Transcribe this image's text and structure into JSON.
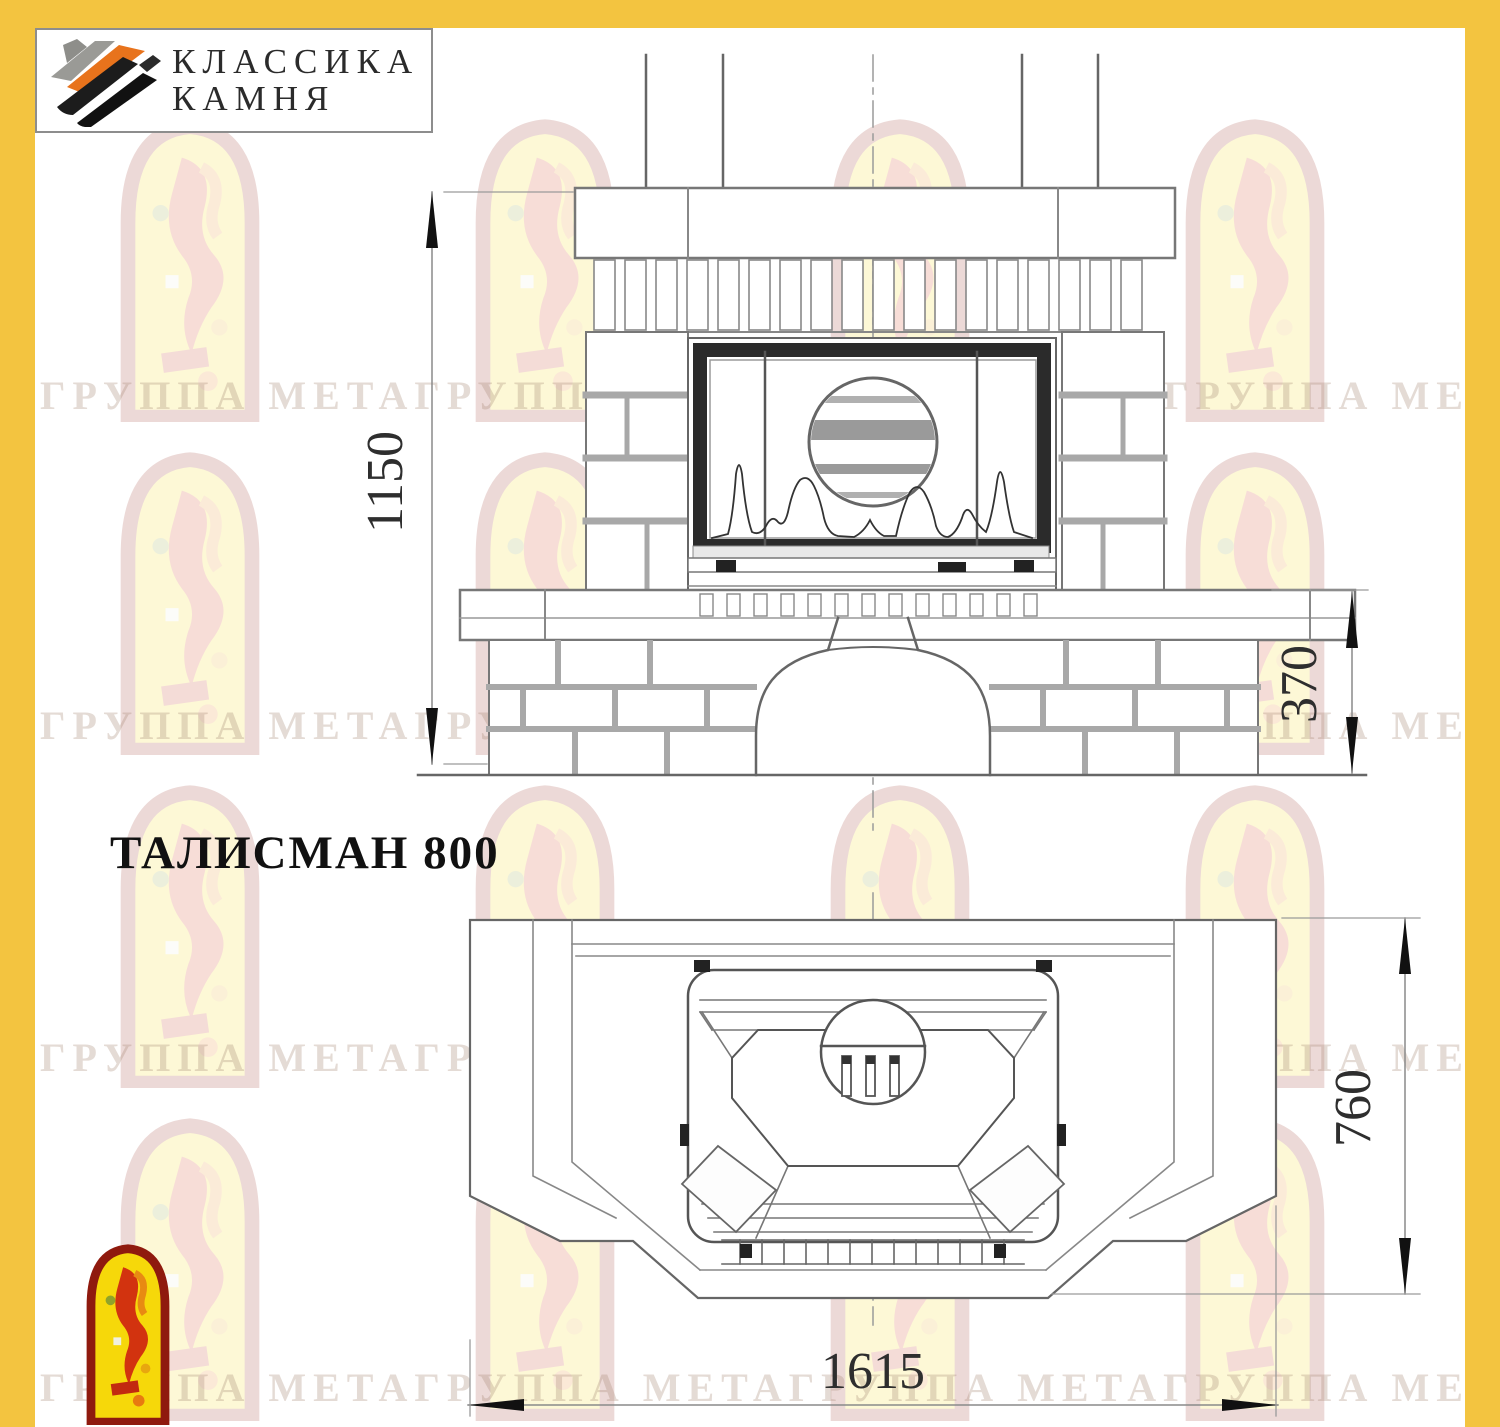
{
  "brand": {
    "name_line1": "КЛАССИКА",
    "name_line2": "КАМНЯ",
    "icon": "stone-slabs-icon"
  },
  "drawing": {
    "title": "ТАЛИСМАН 800",
    "views": {
      "front_view": "fireplace-front-elevation",
      "plan_view": "fireplace-top-plan"
    },
    "dimensions": {
      "front_total_height": "1150",
      "bench_height": "370",
      "plan_depth": "760",
      "plan_width": "1615"
    }
  },
  "watermark": {
    "row_text": "ГРУППА МЕТАГРУППА МЕТАГРУППА МЕТАГРУППА МЕТА",
    "arch_icon": "meta-arch-logo"
  },
  "colors": {
    "frame_yellow": "#F3C440",
    "logo_arch_red": "#8F1A0E",
    "logo_arch_yellow": "#F6D80A",
    "logo_stone_orange": "#E8731C",
    "line_gray": "#666666"
  }
}
